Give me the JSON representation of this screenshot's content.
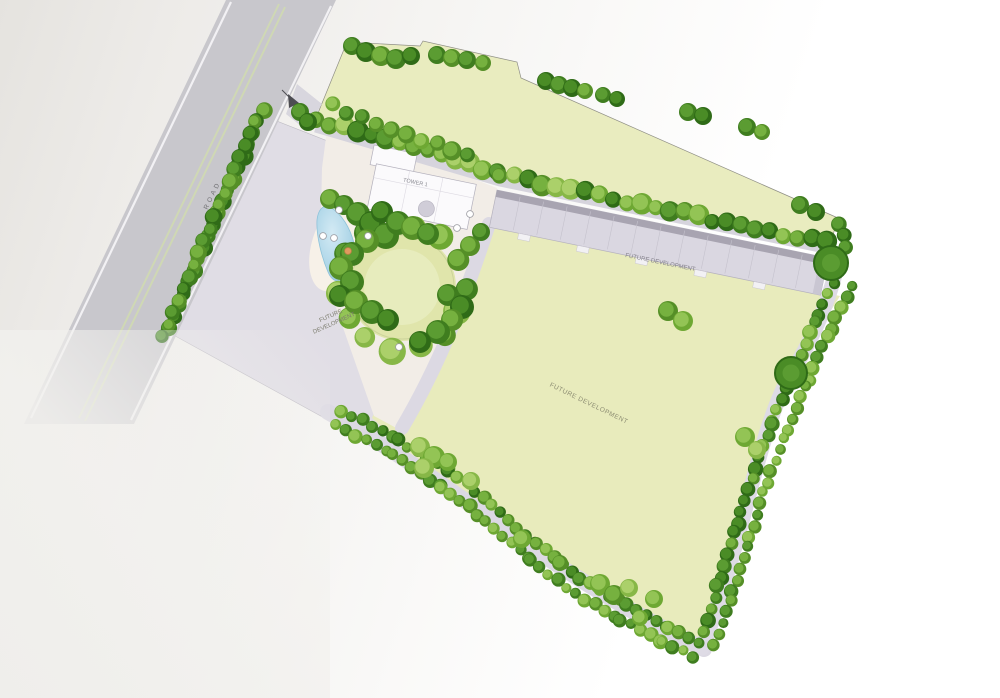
{
  "plan": {
    "labels": {
      "road": "ROAD",
      "tower": "TOWER 1",
      "left_parcel_line1": "FUTURE",
      "left_parcel_line2": "DEVELOPMENT",
      "strip": "FUTURE DEVELOPMENT",
      "field": "FUTURE DEVELOPMENT"
    },
    "colors": {
      "paper": "#f4f3f1",
      "field_green": "#e8ebbc",
      "top_parcel_green": "#e9ecbf",
      "lawn_green": "#e0e5ab",
      "lawn_center": "#e9edc2",
      "main_road_grey": "#c8c7cc",
      "inner_road_grey": "#dcd9e3",
      "left_parcel_grey": "#e0dde5",
      "building_face": "#dad7e1",
      "building_shadow": "#a8a4b1",
      "building_end": "#c9c6d2",
      "podium": "#f2ede7",
      "pool_blue": "#aed6e8",
      "pool_light": "#cfe7f2",
      "median_green": "#cfd8b4",
      "curb_white": "#f2f1f4",
      "marker_white": "#ffffff",
      "marker_orange": "#e09a5f",
      "tree_palette": [
        {
          "fill": "#4a8c26",
          "shade": "#2f6b17"
        },
        {
          "fill": "#5b9c32",
          "shade": "#3f7d1f"
        },
        {
          "fill": "#76b13f",
          "shade": "#558f27"
        },
        {
          "fill": "#93c455",
          "shade": "#6ea833"
        },
        {
          "fill": "#abd06a",
          "shade": "#87b747"
        },
        {
          "fill": "#c4dc87",
          "shade": "#a3c55e"
        }
      ]
    }
  }
}
